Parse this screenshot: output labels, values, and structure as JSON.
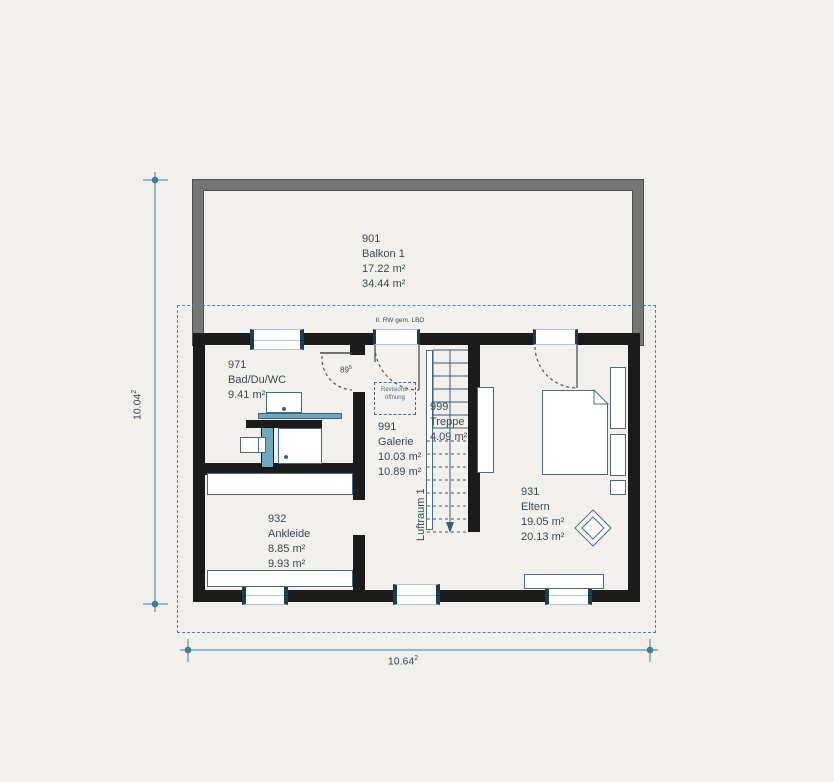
{
  "rooms": [
    {
      "id": "901",
      "name": "Balkon 1",
      "area1": "17.22 m²",
      "area2": "34.44 m²"
    },
    {
      "id": "971",
      "name": "Bad/Du/WC",
      "area1": "9.41 m²",
      "area2": ""
    },
    {
      "id": "991",
      "name": "Galerie",
      "area1": "10.03 m²",
      "area2": "10.89 m²"
    },
    {
      "id": "999",
      "name": "Treppe",
      "area1": "4.09 m²",
      "area2": ""
    },
    {
      "id": "931",
      "name": "Eltern",
      "area1": "19.05 m²",
      "area2": "20.13 m²"
    },
    {
      "id": "932",
      "name": "Ankleide",
      "area1": "8.85 m²",
      "area2": "9.93 m²"
    }
  ],
  "annotations": {
    "escape_route_note": "II. RW gem. LBO",
    "revision_line1": "Revisions-",
    "revision_line2": "öffnung",
    "door_width": {
      "value": "89",
      "sup": "5"
    },
    "void_label": "Luftraum 1"
  },
  "dimensions": {
    "width": {
      "value": "10.64",
      "sup": "2"
    },
    "height": {
      "value": "10.04",
      "sup": "2"
    }
  },
  "colors": {
    "background": "#f0efec",
    "wall": "#1b1b1b",
    "balcony_band": "#767676",
    "window_glass": "#a9c7d8",
    "window_frame": "#1d3d55",
    "accent_teal": "#4b87a0",
    "fixture_blue": "#6fa7c0",
    "line_blue": "#4a6a80",
    "text": "#3a4754"
  }
}
